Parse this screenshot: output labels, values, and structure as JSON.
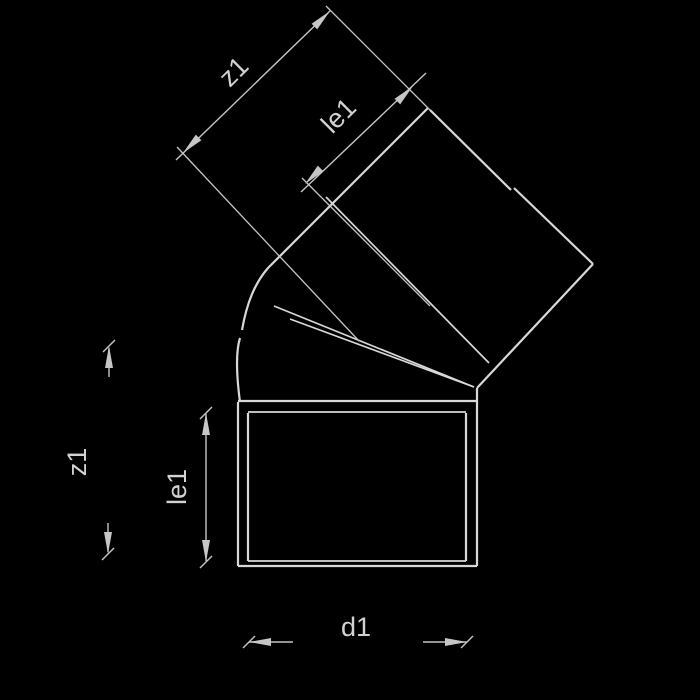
{
  "drawing": {
    "type": "technical-fitting-diagram",
    "subject": "45-degree elbow pipe fitting, side view with dimensioning",
    "labels": {
      "z1_diagonal": "z1",
      "le1_diagonal": "le1",
      "z1_vertical": "z1",
      "le1_vertical": "le1",
      "d1_bottom": "d1"
    },
    "colors": {
      "background": "#000000",
      "outline": "#d8d8d8",
      "dimension_lines": "#c6c6c6",
      "label_text": "#d2d2d2"
    }
  }
}
